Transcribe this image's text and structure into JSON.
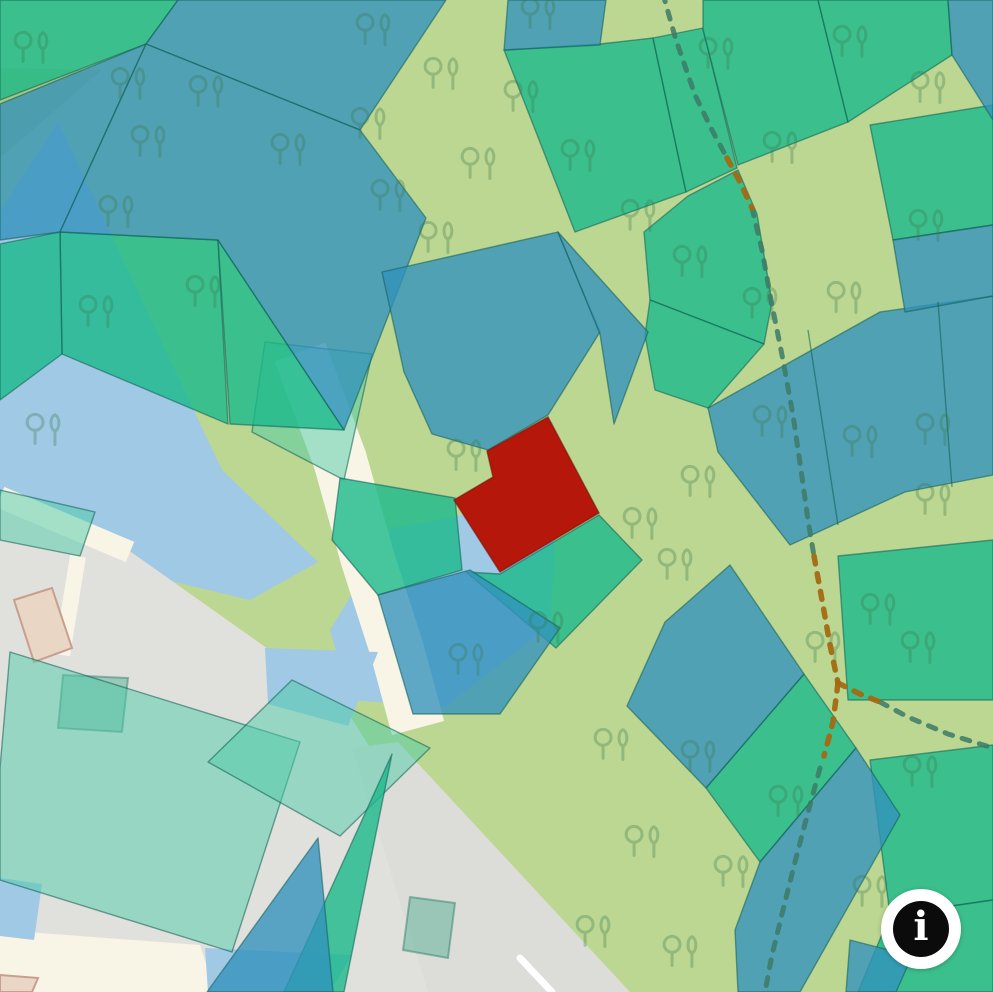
{
  "map": {
    "width": 993,
    "height": 992,
    "colors": {
      "bg": "#bcd791",
      "olive": "#a9c77e",
      "water": "#9fc9e5",
      "urban": "#e0e0dd",
      "urban2": "#dcddd9",
      "road": "#f8f4e6",
      "road_marking": "#ffffff",
      "parcel_green": "rgba(26,185,139,0.80)",
      "parcel_blue": "rgba(50,146,188,0.78)",
      "parcel_mint": "rgba(77,204,167,0.50)",
      "parcel_border": "rgba(16,92,84,0.55)",
      "selected_red": "#b5170b",
      "selected_border": "rgba(120,18,8,0.6)",
      "tree": "#3d7a50",
      "trail_green": "#3c7a66",
      "trail_brown": "#a36a12",
      "building_beige": "#e9d6c4",
      "building_beige_stroke": "#c89f8e",
      "building_green": "rgba(70,170,140,0.45)",
      "building_green_stroke": "rgba(40,120,100,0.45)"
    },
    "olive_patch": "0,68 102,70 0,158",
    "water": [
      "58,122 222,470 318,562 250,600 0,540 0,212",
      "330,630 392,528 558,497 550,625 445,707 350,700"
    ],
    "water_top": [
      "265,648 378,652 348,726 268,704",
      "0,878 42,884 34,940 0,936",
      "205,948 352,955 330,992 208,992"
    ],
    "urban_areas": [
      "0,508 100,530 230,622 340,700 425,835 470,992 0,992",
      "398,742 630,992 428,992 352,748"
    ],
    "roads": [
      {
        "pts": "300,352 340,460 368,560 397,650 418,728",
        "w": 54
      },
      {
        "pts": "0,497 130,552",
        "w": 22
      },
      {
        "pts": "78,556 62,655",
        "w": 16
      }
    ],
    "road_polys": [
      "0,930 200,945 215,992 0,992"
    ],
    "road_marking": {
      "pts": "520,958 552,992",
      "w": 7
    },
    "buildings": [
      {
        "pts": "14,600 52,588 72,648 34,662",
        "kind": "beige"
      },
      {
        "pts": "63,675 128,678 122,732 58,728",
        "kind": "green"
      },
      {
        "pts": "410,897 455,903 448,958 403,950",
        "kind": "green"
      },
      {
        "pts": "0,975 38,978 32,992 0,992",
        "kind": "beige"
      }
    ],
    "parcels": [
      {
        "t": "m",
        "p": "10,652 300,742 232,952 0,880 0,768"
      },
      {
        "t": "m",
        "p": "292,680 430,748 340,836 208,762"
      },
      {
        "t": "m",
        "p": "0,490 95,512 80,556 0,540"
      },
      {
        "t": "m",
        "p": "265,342 372,354 344,480 252,432"
      },
      {
        "t": "g",
        "p": "0,0 178,0 146,44 0,100"
      },
      {
        "t": "g",
        "p": "60,232 218,240 228,424 62,354"
      },
      {
        "t": "g",
        "p": "0,244 60,232 62,354 0,400"
      },
      {
        "t": "g",
        "p": "218,240 344,430 230,424"
      },
      {
        "t": "g",
        "p": "340,478 455,498 462,570 378,595 332,540"
      },
      {
        "t": "g",
        "p": "500,574 599,515 642,560 556,648 466,572"
      },
      {
        "t": "g",
        "p": "504,50 600,44 653,38 686,192 575,232"
      },
      {
        "t": "g",
        "p": "653,38 703,28 737,168 686,192"
      },
      {
        "t": "g",
        "p": "703,0 818,0 848,122 738,165 703,30"
      },
      {
        "t": "g",
        "p": "818,0 948,0 952,55 848,122"
      },
      {
        "t": "g",
        "p": "688,196 738,170 757,214 772,302 764,344 650,300 644,232"
      },
      {
        "t": "g",
        "p": "870,125 993,105 993,225 893,240"
      },
      {
        "t": "g",
        "p": "838,556 993,540 993,700 848,700"
      },
      {
        "t": "g",
        "p": "870,760 993,745 993,900 890,915"
      },
      {
        "t": "g",
        "p": "890,915 993,900 993,992 858,992"
      },
      {
        "t": "g",
        "p": "706,788 804,674 856,748 760,862"
      },
      {
        "t": "g",
        "p": "650,300 764,344 708,408 655,390 645,335"
      },
      {
        "t": "g",
        "p": "392,754 344,992 284,992"
      },
      {
        "t": "b",
        "p": "178,0 446,0 360,130 146,44"
      },
      {
        "t": "b",
        "p": "0,104 146,44 60,232 0,240"
      },
      {
        "t": "b",
        "p": "60,232 146,44 360,130 426,218 344,430 218,240"
      },
      {
        "t": "b",
        "p": "508,0 606,0 600,45 504,50"
      },
      {
        "t": "b",
        "p": "948,0 993,0 993,120 952,55"
      },
      {
        "t": "b",
        "p": "382,272 558,232 600,332 548,415 488,450 432,434 404,372"
      },
      {
        "t": "b",
        "p": "558,232 648,332 614,424 600,334"
      },
      {
        "t": "b",
        "p": "708,408 880,312 993,296 993,475 905,492 790,545 718,452"
      },
      {
        "t": "b",
        "p": "893,240 993,225 993,296 905,312"
      },
      {
        "t": "b",
        "p": "665,622 730,565 804,674 706,788 627,706"
      },
      {
        "t": "b",
        "p": "760,862 856,748 900,815 800,992 738,992 735,930"
      },
      {
        "t": "b",
        "p": "850,940 912,956 896,992 846,992"
      },
      {
        "t": "b",
        "p": "378,595 470,570 560,628 500,714 413,714"
      },
      {
        "t": "b",
        "p": "318,838 333,992 207,992"
      }
    ],
    "parcel_inner_borders": [
      "808,330 838,525",
      "938,302 952,487"
    ],
    "selected_parcel": "548,417 599,513 500,572 454,500 493,477 487,451",
    "trees": [
      [
        33,
        48
      ],
      [
        130,
        84
      ],
      [
        208,
        92
      ],
      [
        150,
        142
      ],
      [
        290,
        150
      ],
      [
        118,
        212
      ],
      [
        205,
        292
      ],
      [
        98,
        312
      ],
      [
        45,
        430
      ],
      [
        375,
        30
      ],
      [
        540,
        14
      ],
      [
        443,
        74
      ],
      [
        370,
        124
      ],
      [
        523,
        97
      ],
      [
        480,
        164
      ],
      [
        390,
        196
      ],
      [
        438,
        238
      ],
      [
        580,
        156
      ],
      [
        640,
        216
      ],
      [
        718,
        54
      ],
      [
        782,
        148
      ],
      [
        852,
        42
      ],
      [
        930,
        88
      ],
      [
        692,
        262
      ],
      [
        762,
        304
      ],
      [
        928,
        226
      ],
      [
        846,
        298
      ],
      [
        772,
        422
      ],
      [
        862,
        442
      ],
      [
        935,
        430
      ],
      [
        700,
        482
      ],
      [
        642,
        524
      ],
      [
        677,
        565
      ],
      [
        466,
        456
      ],
      [
        548,
        628
      ],
      [
        468,
        660
      ],
      [
        613,
        745
      ],
      [
        700,
        757
      ],
      [
        788,
        802
      ],
      [
        922,
        772
      ],
      [
        644,
        842
      ],
      [
        733,
        872
      ],
      [
        872,
        892
      ],
      [
        595,
        932
      ],
      [
        682,
        952
      ],
      [
        935,
        500
      ],
      [
        880,
        610
      ],
      [
        920,
        648
      ],
      [
        825,
        648
      ]
    ],
    "trails": {
      "green": [
        "663,-6 676,40 695,95 712,130 727,158",
        "752,208 762,250 771,300 782,355 793,415 801,470 808,520 814,556",
        "820,768 806,820 795,862 783,910 772,955 765,992",
        "880,702 908,717 948,734 993,748"
      ],
      "brown": [
        "727,158 740,182 752,208",
        "814,556 822,600 830,645 838,683",
        "838,683 860,694 880,702",
        "838,683 833,722 824,756"
      ]
    }
  },
  "info": {
    "label": "i"
  }
}
